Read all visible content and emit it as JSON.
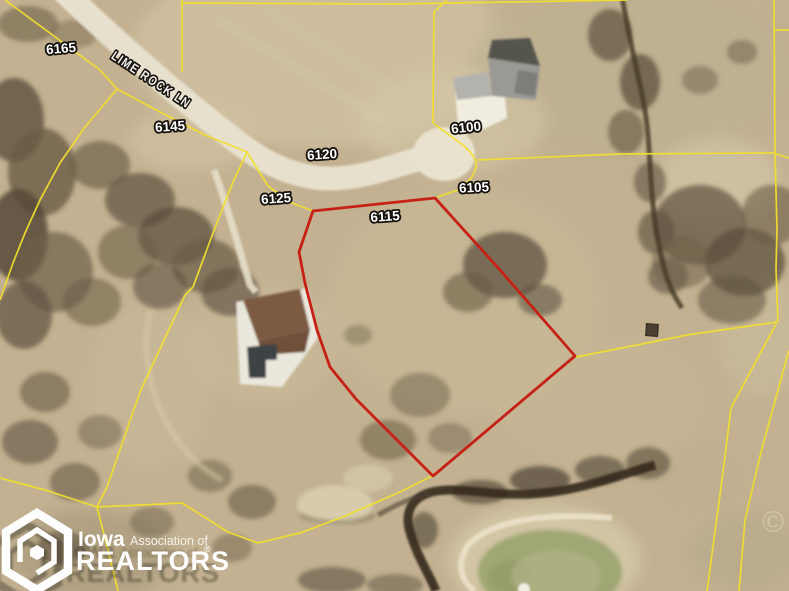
{
  "map": {
    "road_label": "LIME ROCK LN",
    "parcels": {
      "p6165": "6165",
      "p6145": "6145",
      "p6125": "6125",
      "p6120": "6120",
      "p6115": "6115",
      "p6105": "6105",
      "p6100": "6100"
    },
    "colors": {
      "parcel_line": "#f2df2e",
      "property_outline": "#c62114",
      "label_fill": "#ffffff"
    }
  },
  "logo": {
    "brand": "Iowa",
    "secondary": "Association of",
    "name": "REALTORS",
    "registered": "®"
  },
  "watermark": {
    "symbol": "©"
  }
}
